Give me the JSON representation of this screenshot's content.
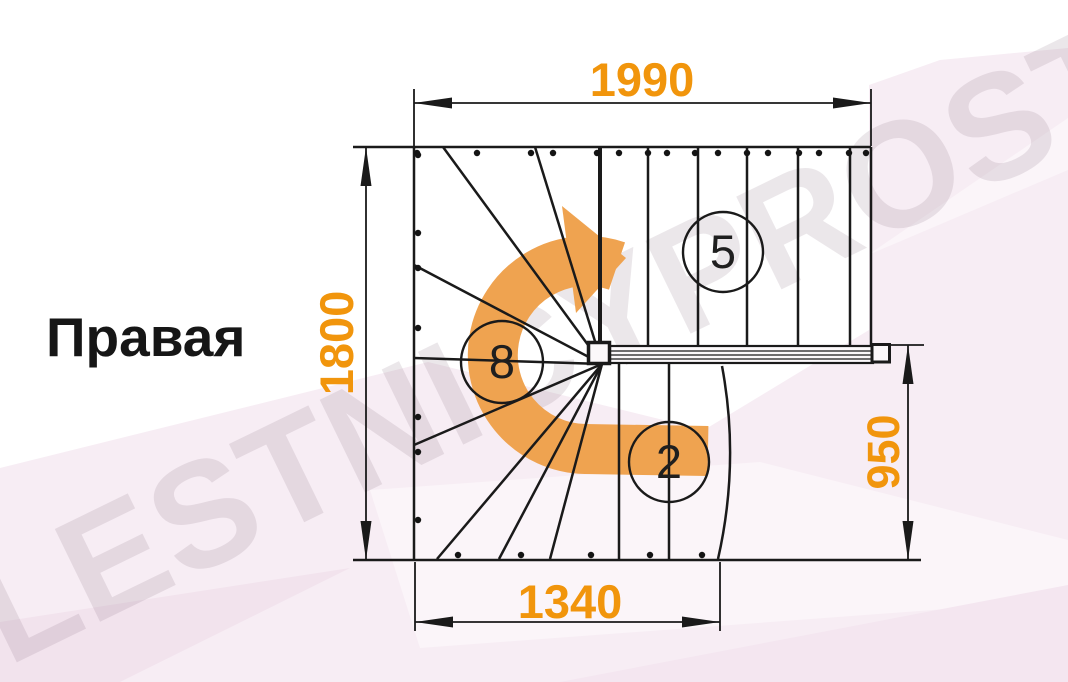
{
  "title": "Правая",
  "watermark_text": "LESTNICYPROSTO.RU",
  "stair_plan": {
    "step_labels": {
      "top_flight": "5",
      "winder": "8",
      "bottom_flight": "2"
    },
    "dimensions_mm": {
      "top_width": "1990",
      "left_height": "1800",
      "right_height": "950",
      "bottom_width": "1340"
    }
  },
  "colors": {
    "dimension_orange": "#F1950C",
    "arrow_orange": "#EFA350",
    "line_black": "#1A1A1A",
    "background_pink": "#F7EDF4",
    "watermark_gray": "rgba(130,105,125,0.16)"
  }
}
